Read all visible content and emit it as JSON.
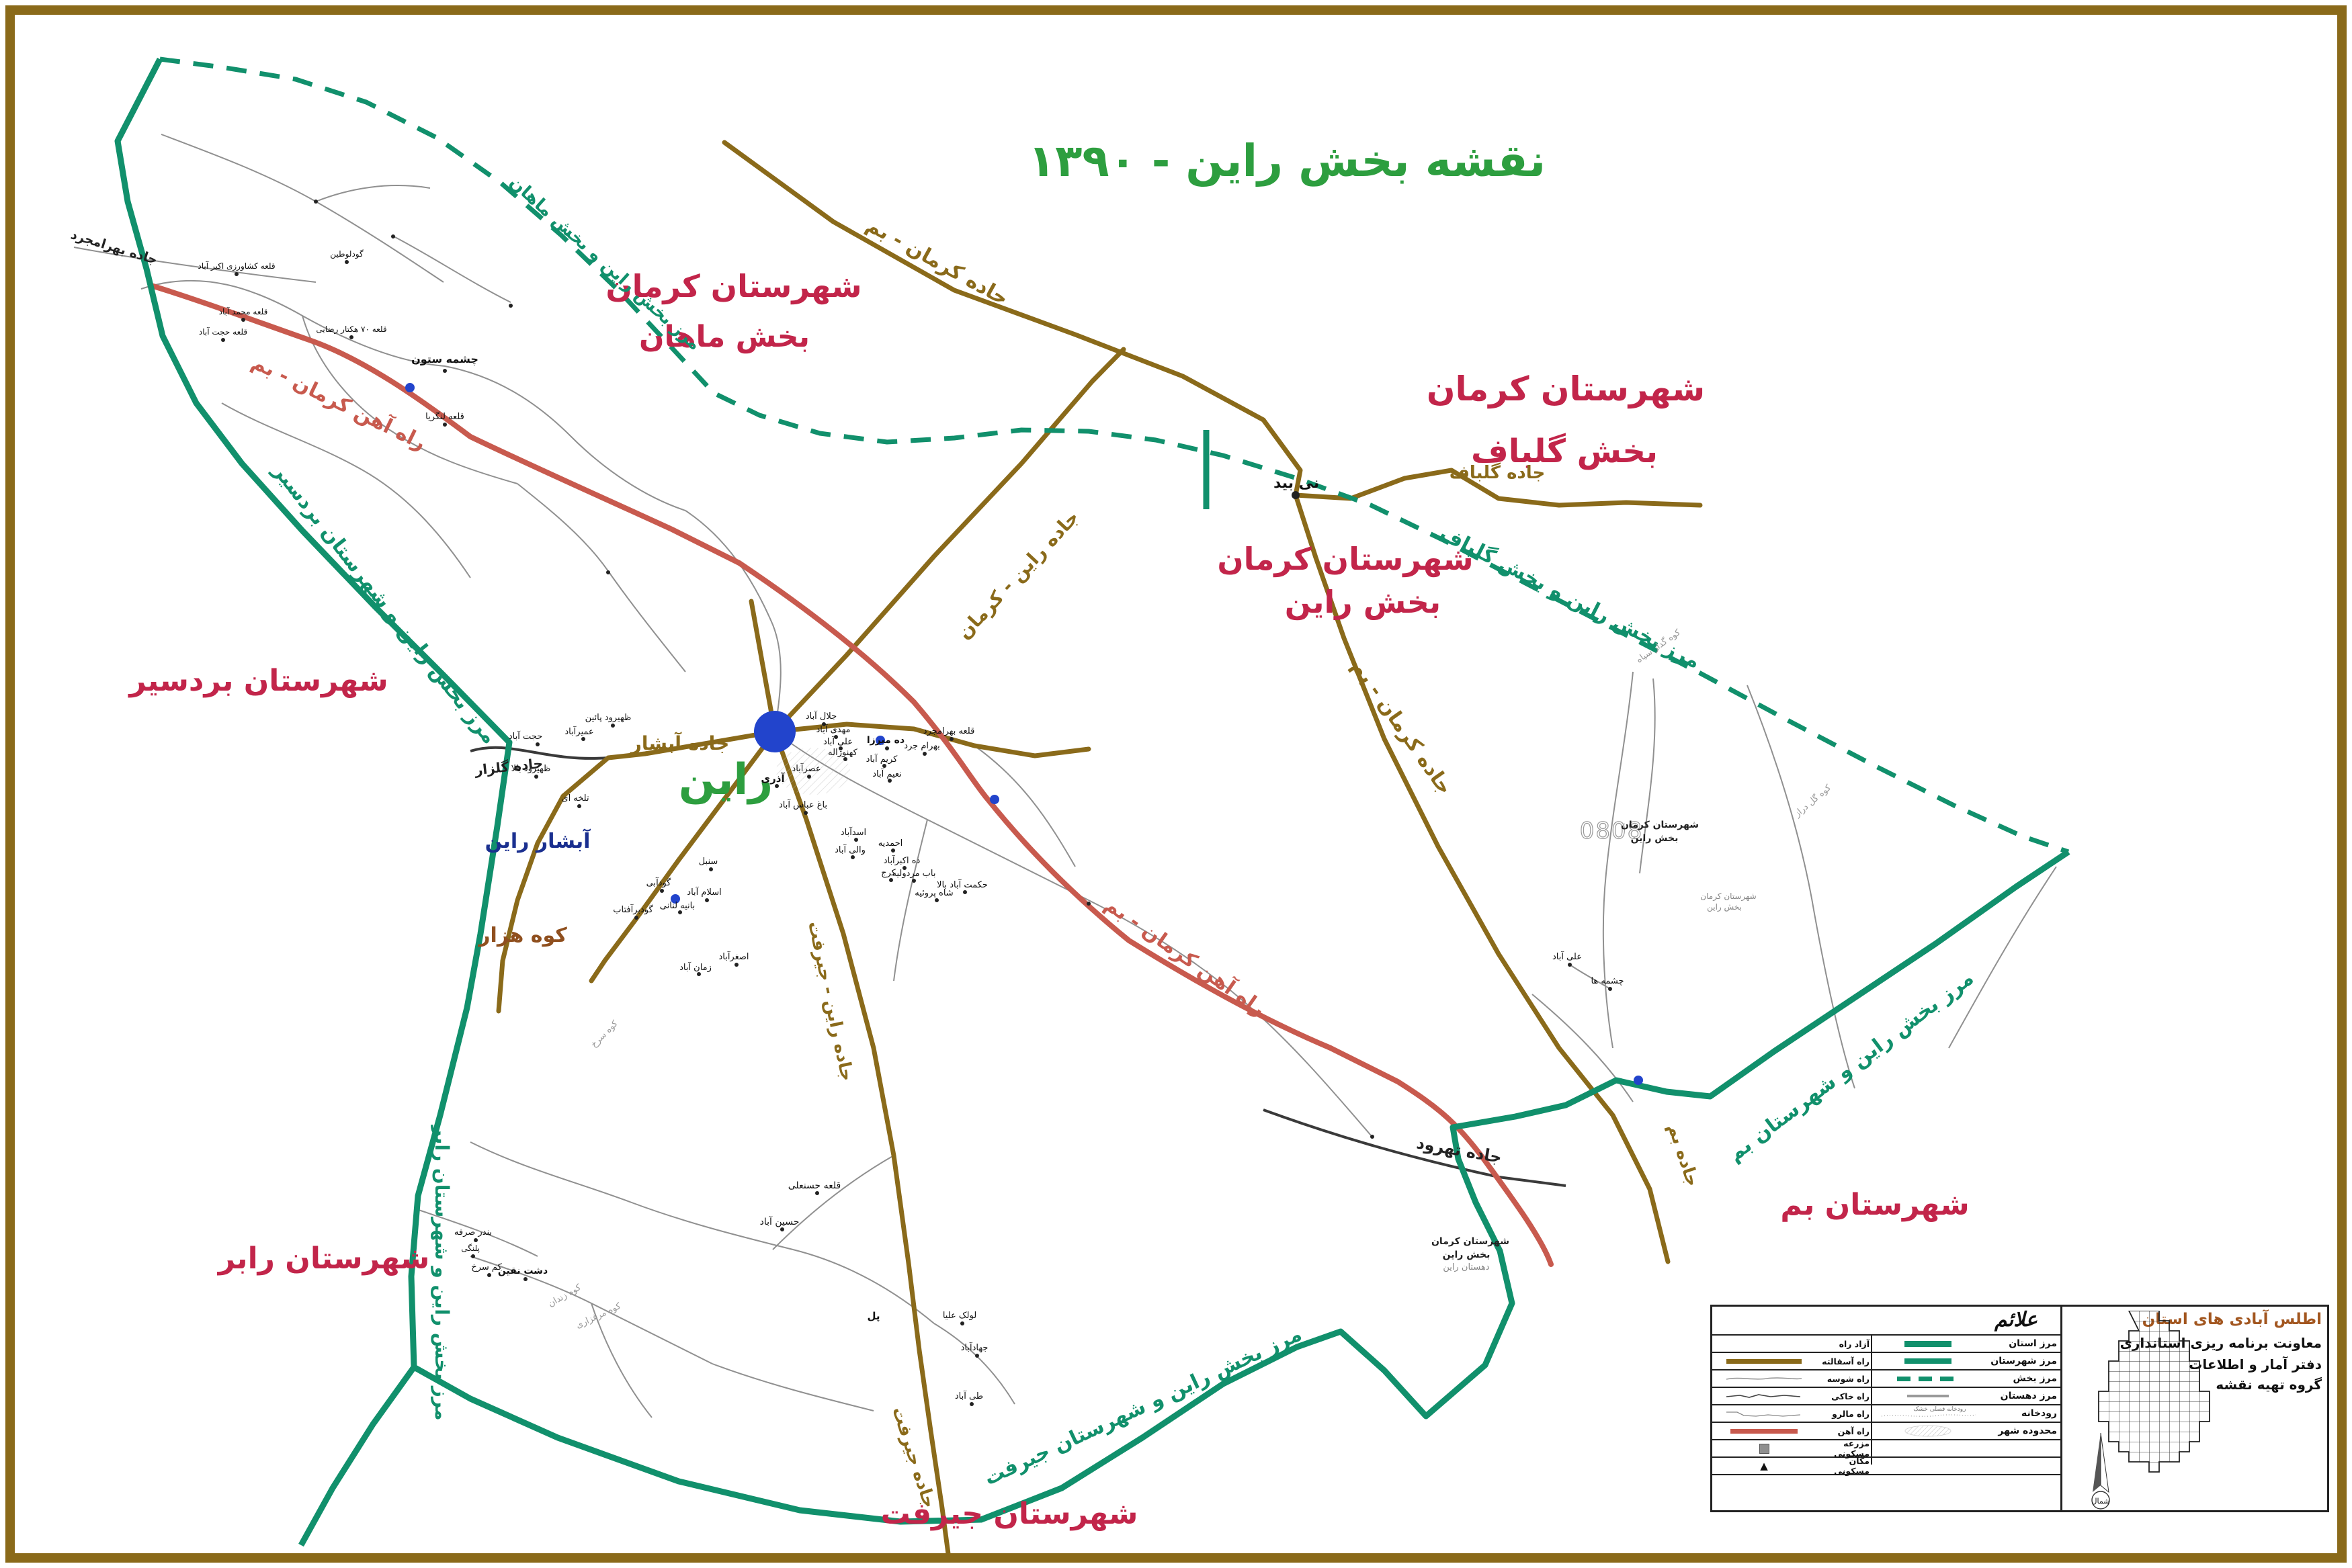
{
  "title": "نقشه بخش راین - ۱۳۹۰",
  "regions": {
    "kerman": "شهرستان کرمان",
    "mahan": "بخش ماهان",
    "golbaf": "بخش گلباف",
    "rain": "بخش راین",
    "bardsir": "شهرستان بردسیر",
    "rabor": "شهرستان رابر",
    "jiroft": "شهرستان جیرفت",
    "bam": "شهرستان بم"
  },
  "borders": {
    "mahan": "مرز بخش راین و بخش ماهان",
    "golbaf": "مرز بخش راین و بخش گلباف",
    "bardsir": "مرز بخش راین و شهرستان بردسیر",
    "rabor": "مرز بخش راین و شهرستان رابر",
    "jiroft": "مرز بخش راین و شهرستان جیرفت",
    "bam": "مرز بخش راین و شهرستان بم"
  },
  "roads": {
    "kerman_bam": "جاده کرمان - بم",
    "rain_kerman": "جاده راین - کرمان",
    "golbaf": "جاده گلباف",
    "bam": "جاده بم",
    "abshar": "جاده آبشار",
    "rain_jiroft": "جاده راین - جیرفت",
    "jiroft": "جاده جیرفت",
    "golzar": "جاده گلزار",
    "tahrud": "جاده تهرود",
    "bahramjerd": "جاده بهرامجرد"
  },
  "railway_label": "راه آهن کرمان - بم",
  "city": {
    "name": "راین"
  },
  "places": {
    "abshar": "آبشار راین",
    "kuh_hezar": "کوه هزار"
  },
  "map_code": "0808",
  "small_notes": {
    "a1": "شهرستان کرمان",
    "a2": "بخش راین",
    "b1": "شهرستان کرمان",
    "b2": "بخش راین",
    "b3": "دهستان راین"
  },
  "villages": [
    "نی بید",
    "چشمه ستون",
    "قلعه لنگریا",
    "حجت آباد",
    "ظهیرود پائین",
    "عمیرآباد",
    "ظهیرود بالا",
    "تلخه ای",
    "اسلام آباد",
    "بانیه لنانی",
    "گودآبی",
    "گودبرآفتاب",
    "سنبل",
    "اصغرآباد",
    "زمان آباد",
    "جلال آباد",
    "مهدی آباد",
    "علی آباد",
    "کهنوژاله",
    "ده میرزا",
    "کریم آباد",
    "نعیم آباد",
    "بهرام جرد",
    "قلعه بهرامجرد",
    "عصرآباد",
    "آذری",
    "باغ عباس آباد",
    "اسدآباد",
    "والی آباد",
    "احمدیه",
    "ده اکبرآباد",
    "کرج",
    "باب مردولیه",
    "شاه پروئیه",
    "حکمت آباد بالا",
    "قلعه حسنعلی",
    "حسین آباد",
    "لولک علیا",
    "جهادآباد",
    "طی آباد",
    "علی آباد",
    "چشمه ها",
    "دشت نقین",
    "کم سرخ",
    "پلنگی",
    "بندر صرفه",
    "پل",
    "قلعه کشاورزی اکبر آباد",
    "گودلوطین",
    "قلعه محمد آباد",
    "قلعه حجت آباد",
    "قلعه ۷۰ هکتار رضایی"
  ],
  "mountains": [
    "کوه گدار سیاه",
    "کوه گل دراز",
    "کوه مرغزاری",
    "کوه زندان",
    "کوه سرخ"
  ],
  "legend": {
    "header": "علائم",
    "river_note": "رودخانه فصلی خشک",
    "left_rows": [
      {
        "label": "آزاد راه"
      },
      {
        "label": "راه آسفالته"
      },
      {
        "label": "راه شوسه"
      },
      {
        "label": "راه خاکی"
      },
      {
        "label": "راه مالرو"
      },
      {
        "label": "راه آهن"
      },
      {
        "label": "مزرعه مسکونی"
      },
      {
        "label": "مکان مسکونی"
      }
    ],
    "right_rows": [
      {
        "label": "مرز استان"
      },
      {
        "label": "مرز شهرستان"
      },
      {
        "label": "مرز بخش"
      },
      {
        "label": "مرز دهستان"
      },
      {
        "label": "رودخانه"
      },
      {
        "label": "محدوده شهر"
      }
    ]
  },
  "info_panel": {
    "title": "اطلس آبادی های استان",
    "line1": "معاونت برنامه ریزی استانداری",
    "line2": "دفتر آمار و اطلاعات",
    "line3": "گروه تهیه نقشه",
    "north": "شمال"
  },
  "colors": {
    "frame": "#8a6a1a",
    "border": "#11906c",
    "road": "#8a6a1a",
    "railway": "#c85a4e",
    "region_label": "#c2254a",
    "title": "#2d9e3f",
    "city": "#2244cc",
    "waterfall_label": "#1a2f8f"
  }
}
